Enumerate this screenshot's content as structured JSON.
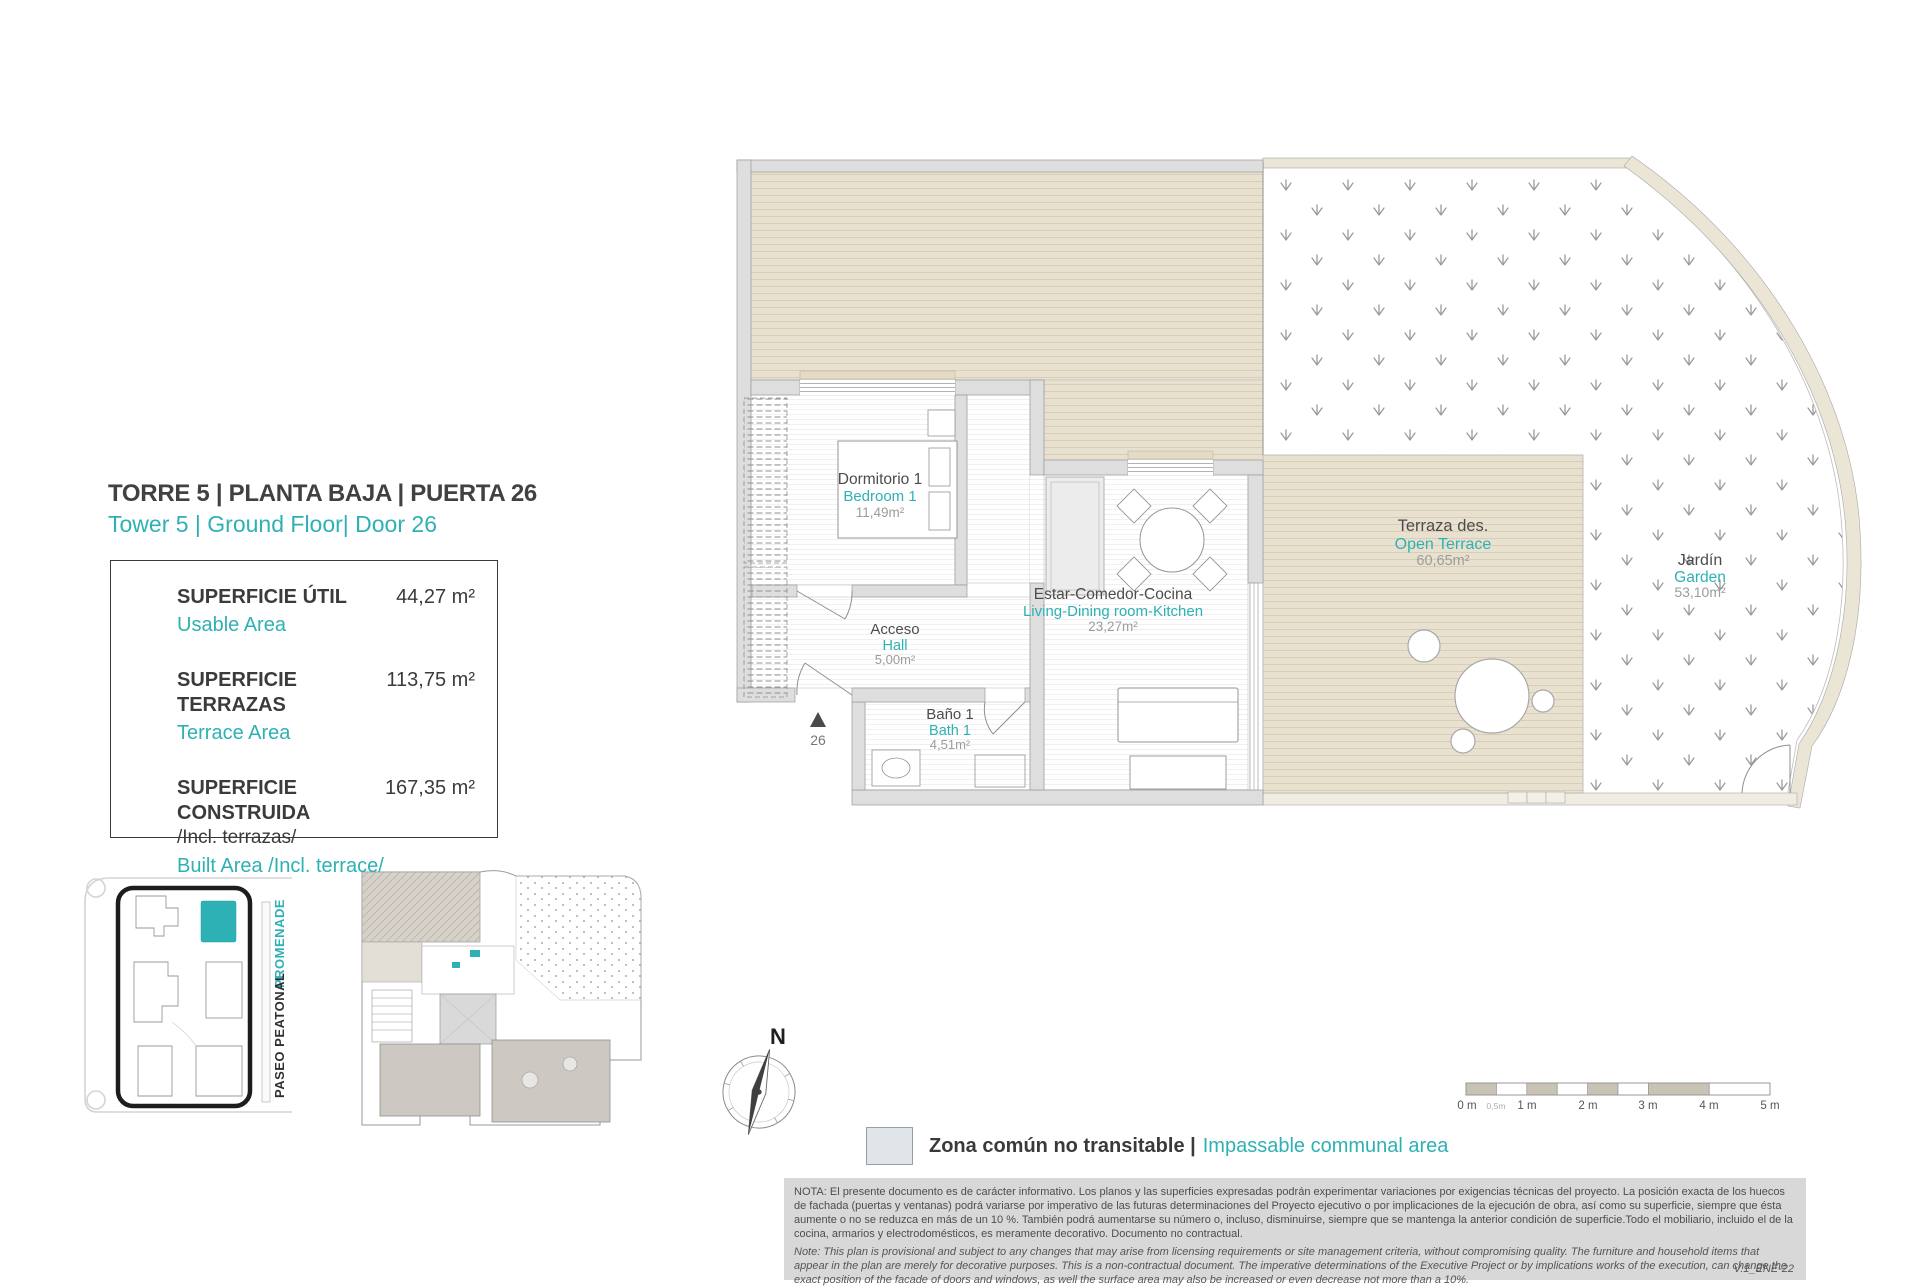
{
  "header": {
    "title_es": "TORRE 5 | PLANTA BAJA | PUERTA 26",
    "title_en": "Tower 5 | Ground Floor| Door 26"
  },
  "area_table": {
    "rows": [
      {
        "label_es": "SUPERFICIE ÚTIL",
        "label_en": "Usable Area",
        "value": "44,27 m²"
      },
      {
        "label_es": "SUPERFICIE TERRAZAS",
        "label_en": "Terrace Area",
        "value": "113,75 m²"
      },
      {
        "label_es": "SUPERFICIE CONSTRUIDA",
        "label_es_note": "/Incl. terrazas/",
        "label_en": "Built Area /Incl. terrace/",
        "value": "167,35 m²"
      }
    ]
  },
  "plan": {
    "rooms": [
      {
        "id": "bedroom1",
        "name_es": "Dormitorio 1",
        "name_en": "Bedroom 1",
        "area": "11,49m²"
      },
      {
        "id": "hall",
        "name_es": "Acceso",
        "name_en": "Hall",
        "area": "5,00m²"
      },
      {
        "id": "bath1",
        "name_es": "Baño 1",
        "name_en": "Bath 1",
        "area": "4,51m²"
      },
      {
        "id": "living",
        "name_es": "Estar-Comedor-Cocina",
        "name_en": "Living-Dining room-Kitchen",
        "area": "23,27m²"
      },
      {
        "id": "terrace",
        "name_es": "Terraza des.",
        "name_en": "Open Terrace",
        "area": "60,65m²"
      },
      {
        "id": "garden",
        "name_es": "Jardín",
        "name_en": "Garden",
        "area": "53,10m²"
      }
    ],
    "door_number": "26",
    "compass_label": "N"
  },
  "site_map": {
    "street_label_es": "PASEO PEATONAL",
    "street_label_en": "PROMENADE"
  },
  "legend": {
    "item_es": "Zona común no transitable |",
    "item_en": "Impassable communal area",
    "swatch_color": "#dfe5e9"
  },
  "scale_bar": {
    "labels": [
      "0 m",
      "0,5m",
      "1 m",
      "2 m",
      "3 m",
      "4 m",
      "5 m"
    ]
  },
  "notes": {
    "nota_es": "NOTA:  El presente documento es de carácter informativo. Los planos y las superficies expresadas podrán experimentar variaciones por exigencias técnicas del proyecto. La posición exacta de los huecos de fachada (puertas y ventanas) podrá variarse por imperativo de las futuras determinaciones del Proyecto ejecutivo o por implicaciones de la ejecución de obra, así como su superficie, siempre que ésta aumente o no se reduzca en más de un 10 %. También podrá aumentarse su número o, incluso, disminuirse, siempre que se mantenga la anterior condición de superficie.Todo el mobiliario, incluido el de la cocina, armarios y electrodomésticos, es meramente decorativo. Documento no contractual.",
    "note_en": "Note: This plan is provisional and subject to any changes that may arise from licensing requirements or site management criteria, without compromising quality. The furniture and household items that appear in the plan are merely for decorative purposes. This is a non-contractual document. The imperative determinations of the Executive Project or by implications works of the execution, can change the exact position of the facade of doors and windows, as well the surface area may also be increased or even decrease not more than a 10%.",
    "version": "V.1_ENE-22"
  },
  "colors": {
    "teal": "#2eb1b5",
    "dark_text": "#3f4143",
    "area_text": "#9c9c9c",
    "deck_beige": "#e9e1d0",
    "deck_stripe": "#d9cdb6",
    "wall_gray": "#dedede",
    "wall_edge": "#9b9b9b",
    "note_bg": "#d8d8d8",
    "legend_swatch": "#dfe5e9"
  }
}
